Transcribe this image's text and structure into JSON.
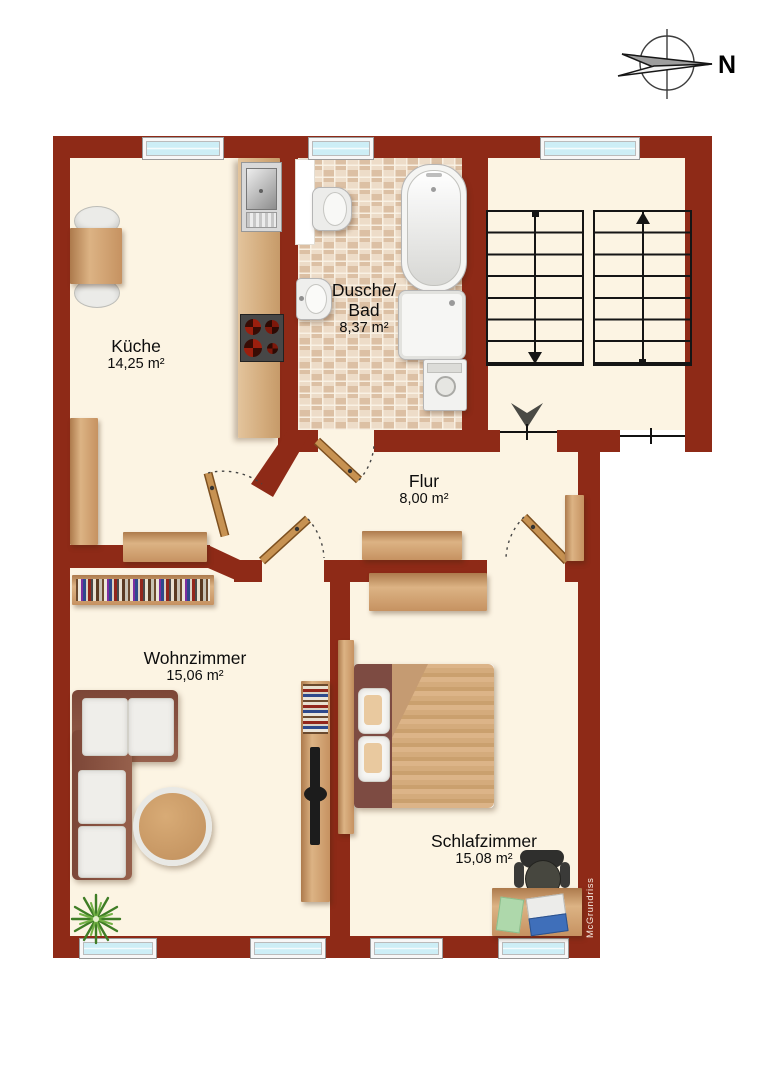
{
  "compass": {
    "label": "N"
  },
  "watermark": "McGrundriss",
  "rooms": {
    "kueche": {
      "name": "Küche",
      "area": "14,25 m²"
    },
    "bad": {
      "line1": "Dusche/",
      "line2": "Bad",
      "area": "8,37 m²"
    },
    "flur": {
      "name": "Flur",
      "area": "8,00 m²"
    },
    "wohnzimmer": {
      "name": "Wohnzimmer",
      "area": "15,06 m²"
    },
    "schlafzimmer": {
      "name": "Schlafzimmer",
      "area": "15,08 m²"
    }
  },
  "colors": {
    "wall": "#8e2a17",
    "floor": "#fcf4e3",
    "tile": "#e6d2bc",
    "wood": "#c69261",
    "window_glass": "#cdeef6"
  }
}
